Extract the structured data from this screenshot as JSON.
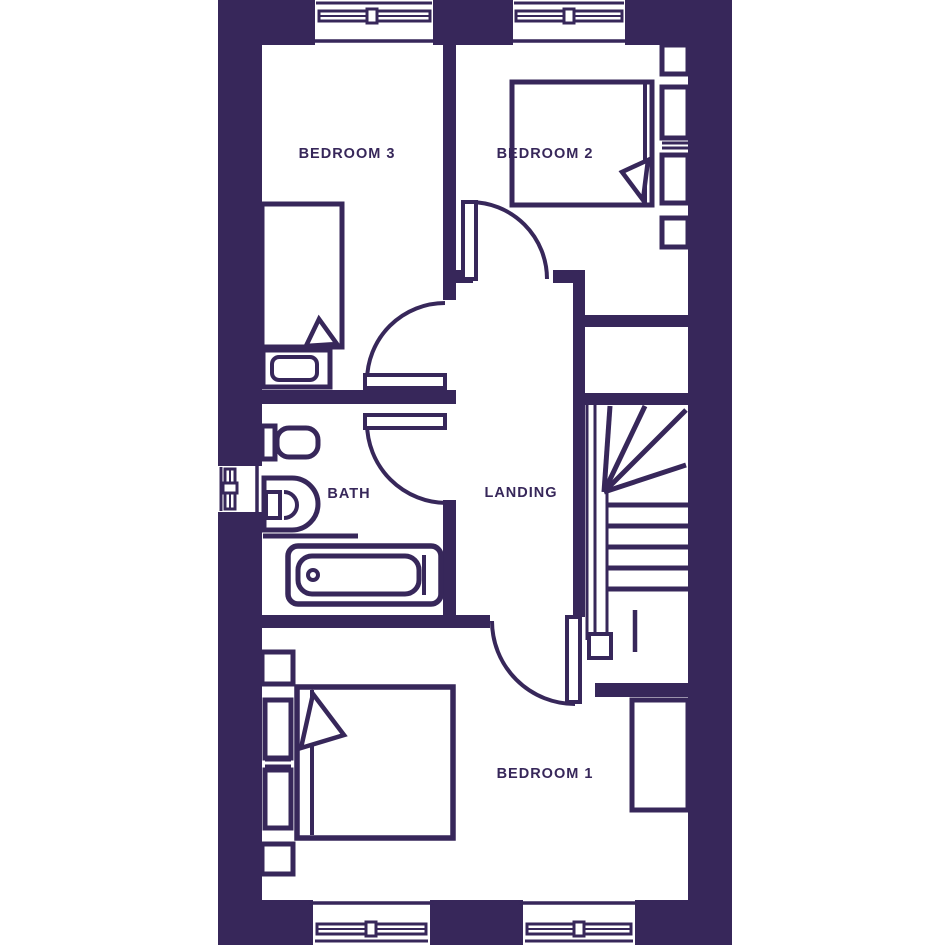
{
  "plan": {
    "name": "first-floor-plan",
    "colors": {
      "wall": "#37275a",
      "floor": "#ffffff"
    },
    "rooms": [
      {
        "id": "bedroom-3",
        "label": "BEDROOM 3"
      },
      {
        "id": "bedroom-2",
        "label": "BEDROOM 2"
      },
      {
        "id": "bath",
        "label": "BATH"
      },
      {
        "id": "landing",
        "label": "LANDING"
      },
      {
        "id": "bedroom-1",
        "label": "BEDROOM 1"
      }
    ],
    "fixtures": [
      "single-bed",
      "double-bed",
      "double-bed",
      "bathtub",
      "toilet",
      "basin",
      "stairs",
      "wardrobe",
      "bedside-units",
      "window",
      "door"
    ]
  }
}
